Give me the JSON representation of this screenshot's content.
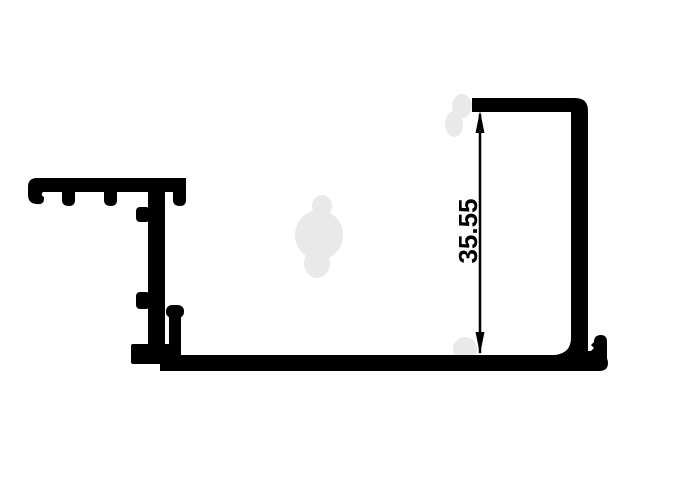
{
  "dimension": {
    "label": "35.55"
  },
  "colors": {
    "line": "#000000",
    "background": "#ffffff",
    "watermark": "#e9e9e9"
  }
}
